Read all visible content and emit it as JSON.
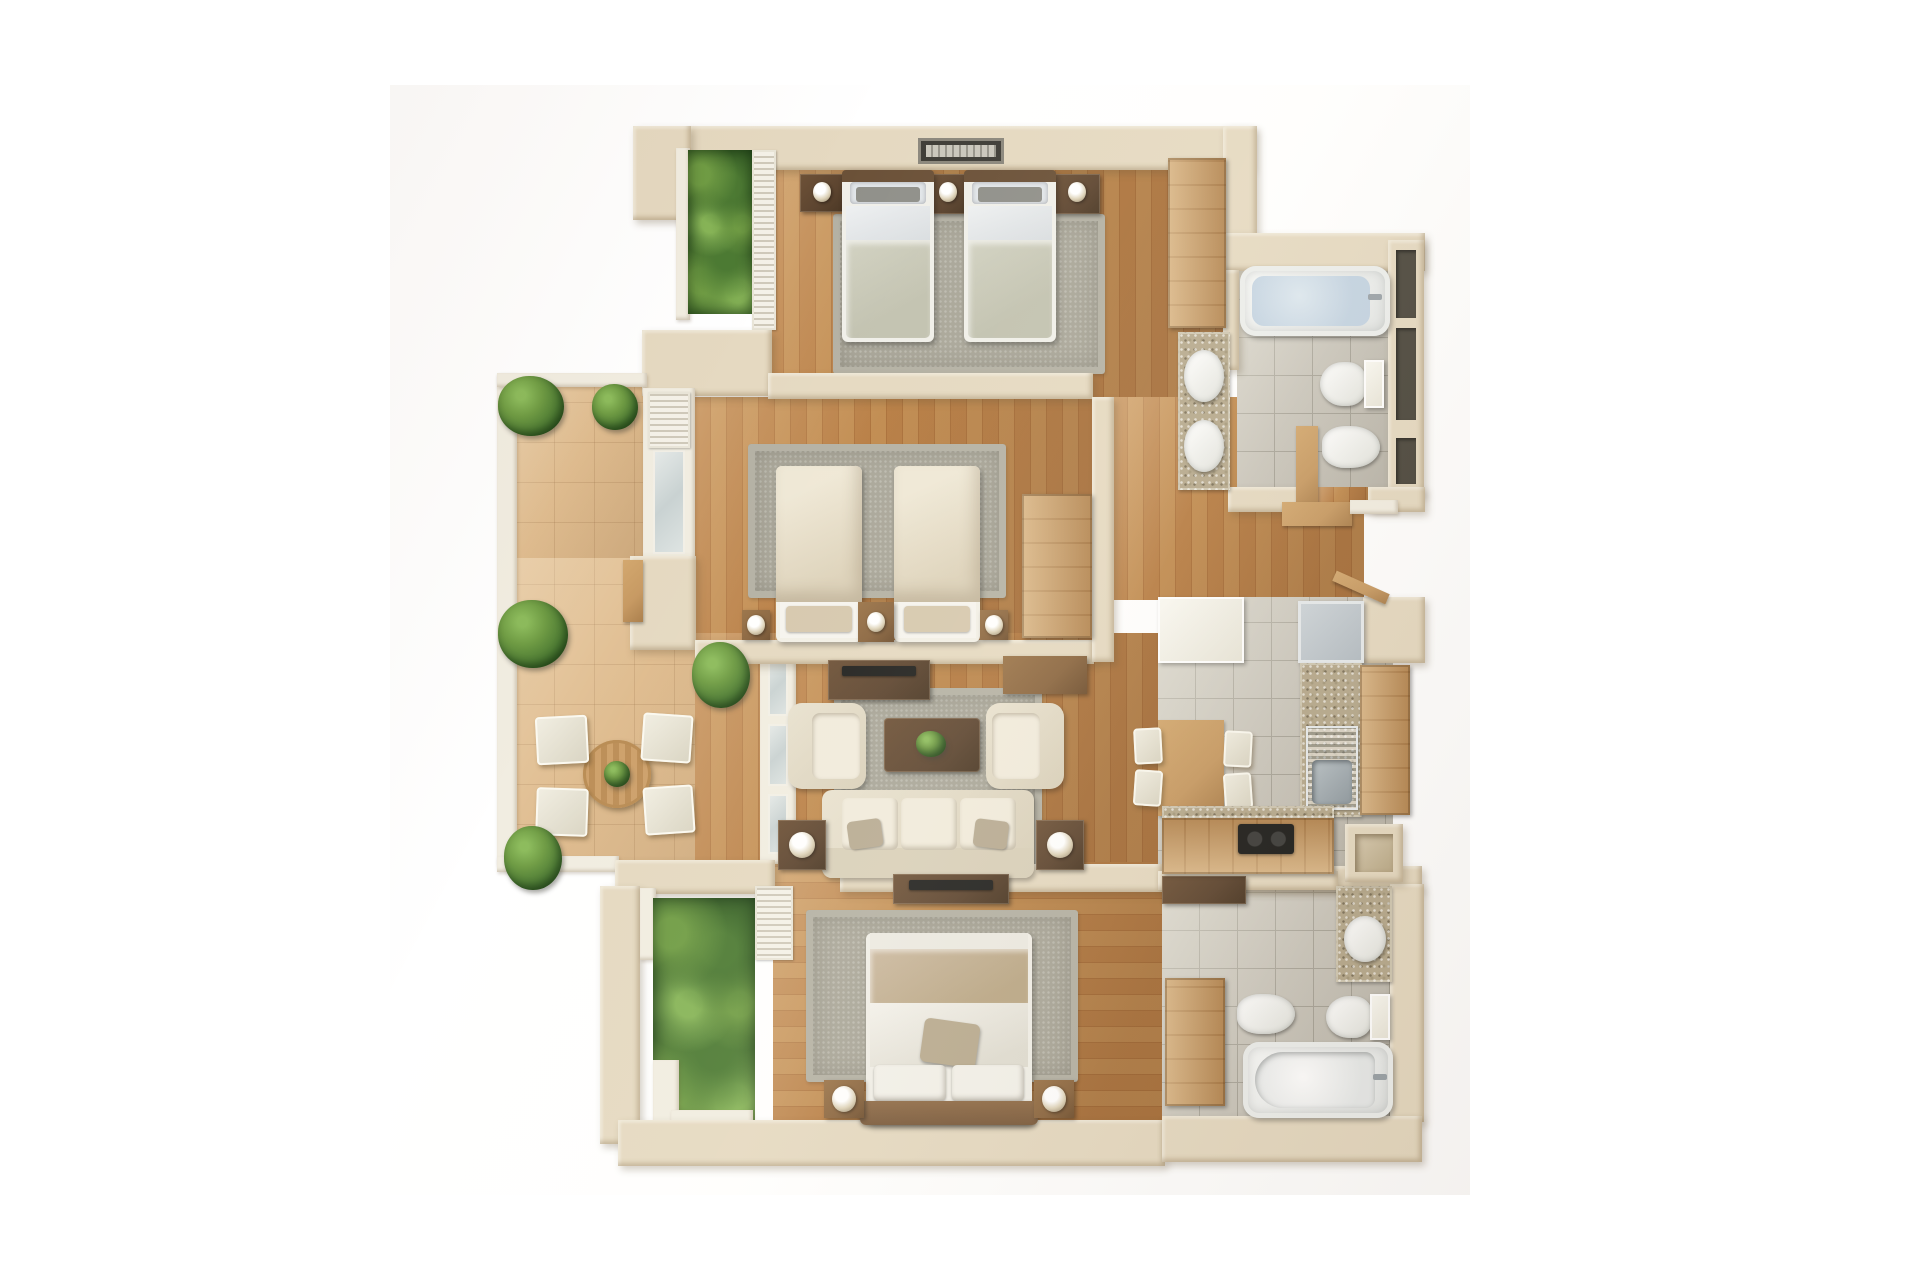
{
  "scene": {
    "type": "3d-floor-plan-top-view",
    "description": "Isometric top-down 3D render of a three-bedroom apartment with terrace, two bathrooms, kitchen and living room on white background",
    "rooms": [
      {
        "name": "bedroom-twin-top",
        "furniture": [
          "twin-bed",
          "twin-bed",
          "nightstand-with-lamp",
          "nightstand-with-lamp",
          "nightstand-with-lamp",
          "area-rug",
          "wardrobe",
          "window",
          "planter-garden"
        ]
      },
      {
        "name": "bathroom-top",
        "furniture": [
          "bathtub",
          "double-sink-vanity",
          "toilet",
          "bidet",
          "door",
          "louvered-windows"
        ]
      },
      {
        "name": "bedroom-twin-middle",
        "furniture": [
          "twin-bed",
          "twin-bed",
          "nightstand",
          "table-lamp",
          "table-lamp",
          "area-rug",
          "desk",
          "tv-console",
          "window"
        ]
      },
      {
        "name": "living-room",
        "furniture": [
          "three-seat-sofa",
          "armchair",
          "armchair",
          "coffee-table-with-plant",
          "side-table-with-lamp",
          "side-table-with-lamp",
          "area-rug",
          "tv-console",
          "plant",
          "french-door"
        ]
      },
      {
        "name": "kitchen",
        "furniture": [
          "white-counter",
          "refrigerator",
          "sink-counter",
          "cooktop-counter",
          "dining-table",
          "chair",
          "chair",
          "chair",
          "chair",
          "pantry-niche"
        ]
      },
      {
        "name": "bedroom-double-bottom",
        "furniture": [
          "double-bed",
          "nightstand-with-lamp",
          "nightstand-with-lamp",
          "area-rug",
          "wardrobe",
          "tv-console",
          "planter-garden"
        ]
      },
      {
        "name": "bathroom-bottom",
        "furniture": [
          "bathtub",
          "sink-vanity",
          "toilet",
          "bidet"
        ]
      },
      {
        "name": "terrace",
        "furniture": [
          "round-dining-table",
          "chair",
          "chair",
          "chair",
          "chair",
          "potted-plant",
          "potted-plant",
          "potted-plant",
          "potted-plant",
          "railing",
          "wood-bench"
        ]
      },
      {
        "name": "entry",
        "furniture": [
          "open-door-leaf",
          "threshold-step",
          "console-table"
        ]
      }
    ]
  },
  "palette": {
    "wall": "#e5d9c1",
    "frame": "#f1ede1",
    "woodA": "#b77c42",
    "woodB": "#aa6f38",
    "woodC": "#c08a4e",
    "sand": "#dfbc8f",
    "tile": "#cac6bc",
    "grout": "#a9a59a",
    "granite": "#b6a98d",
    "rug": "#a9a699",
    "rugEdge": "#b4b1a4",
    "cream": "#e9e2d0",
    "creamDark": "#d9d0ba",
    "darkwood": "#5d4530",
    "midwood": "#8a653f",
    "litewood": "#c79a63",
    "tvblack": "#20201e",
    "water": "#c3d3e2",
    "steel": "#9aa4ab",
    "fridge": "#b3bcc3",
    "green1": "#6f9c44",
    "green2": "#4c7a33",
    "green3": "#2f5722",
    "pillowGray": "#90908a",
    "sheetBlue": "#e2e6e9",
    "blanketSage": "#d2d2c2",
    "blanketBeige": "#cbb9a0",
    "pillowBeige": "#d6c8ae"
  }
}
